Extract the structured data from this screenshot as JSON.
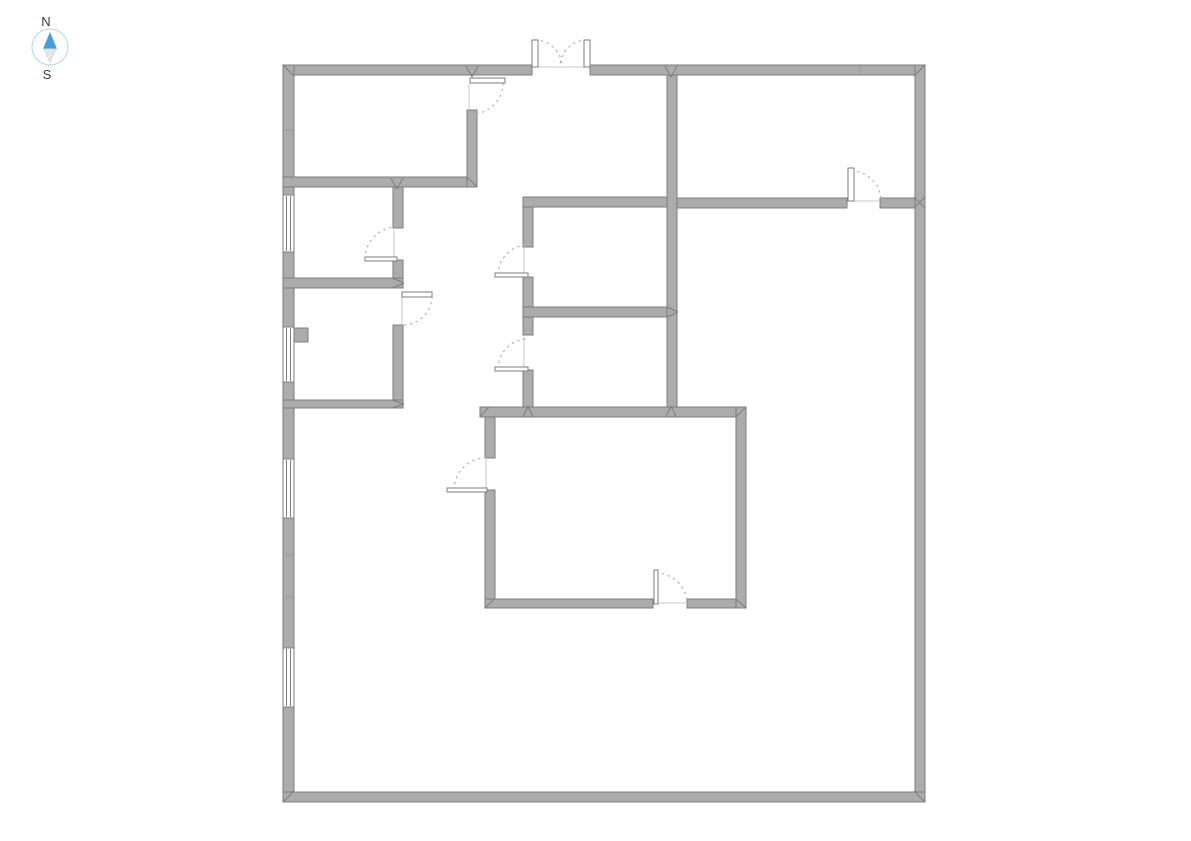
{
  "canvas": {
    "width": 1191,
    "height": 841,
    "background": "#ffffff"
  },
  "compass": {
    "north_label": "N",
    "south_label": "S",
    "cx": 50,
    "cy": 47,
    "r": 18,
    "circle_stroke": "#aed4f2",
    "north_color": "#3f9ede",
    "south_color": "#e4e8ea",
    "south_stroke": "#d2d8da",
    "label_color": "#3a3a3a",
    "north_points": "50,32 43,49 57,49",
    "south_points": "44,49 56,49 50,62"
  },
  "style": {
    "wall_fill": "#acacac",
    "wall_stroke": "#7d7d7d",
    "leaf_fill": "#ffffff",
    "leaf_stroke": "#7d7d7d",
    "arc_color": "#b4b4b4",
    "opening_line_color": "#c9c9c9",
    "seam_color": "#999999",
    "window_fill": "#ffffff",
    "window_stroke": "#7d7d7d"
  },
  "walls": [
    {
      "name": "outer-wall-top-left",
      "x": 283,
      "y": 65,
      "w": 249,
      "h": 10
    },
    {
      "name": "outer-wall-top-right",
      "x": 590,
      "y": 65,
      "w": 335,
      "h": 10
    },
    {
      "name": "outer-wall-left",
      "x": 283,
      "y": 65,
      "w": 11,
      "h": 737
    },
    {
      "name": "outer-wall-right",
      "x": 915,
      "y": 65,
      "w": 10,
      "h": 737
    },
    {
      "name": "outer-wall-bottom",
      "x": 283,
      "y": 792,
      "w": 642,
      "h": 10
    },
    {
      "name": "room1-bottom-wall",
      "x": 283,
      "y": 177,
      "w": 194,
      "h": 10
    },
    {
      "name": "room1-right-wall",
      "x": 467,
      "y": 110,
      "w": 10,
      "h": 77
    },
    {
      "name": "room2-right-wall-upper",
      "x": 393,
      "y": 187,
      "w": 10,
      "h": 41
    },
    {
      "name": "room2-right-wall-lower",
      "x": 393,
      "y": 260,
      "w": 10,
      "h": 28
    },
    {
      "name": "room2-bottom-wall",
      "x": 283,
      "y": 278,
      "w": 120,
      "h": 10
    },
    {
      "name": "room3-right-wall",
      "x": 393,
      "y": 325,
      "w": 10,
      "h": 79
    },
    {
      "name": "room3-bottom-wall",
      "x": 283,
      "y": 400,
      "w": 120,
      "h": 8
    },
    {
      "name": "center-room-top-wall",
      "x": 523,
      "y": 197,
      "w": 144,
      "h": 10
    },
    {
      "name": "center-room-left-stub",
      "x": 523,
      "y": 207,
      "w": 10,
      "h": 40
    },
    {
      "name": "center-room-left-lower",
      "x": 523,
      "y": 277,
      "w": 10,
      "h": 30
    },
    {
      "name": "center-divider-wall",
      "x": 523,
      "y": 307,
      "w": 154,
      "h": 10
    },
    {
      "name": "center-room2-left-upper",
      "x": 523,
      "y": 317,
      "w": 10,
      "h": 18
    },
    {
      "name": "center-room2-left-lower",
      "x": 523,
      "y": 370,
      "w": 10,
      "h": 37
    },
    {
      "name": "main-vertical-wall",
      "x": 667,
      "y": 75,
      "w": 10,
      "h": 332
    },
    {
      "name": "right-room-bottom-left",
      "x": 677,
      "y": 198,
      "w": 170,
      "h": 10
    },
    {
      "name": "right-room-bottom-right",
      "x": 880,
      "y": 198,
      "w": 35,
      "h": 10
    },
    {
      "name": "big-room-top-wall",
      "x": 480,
      "y": 407,
      "w": 266,
      "h": 10
    },
    {
      "name": "big-room-left-upper",
      "x": 485,
      "y": 417,
      "w": 10,
      "h": 41
    },
    {
      "name": "big-room-left-lower",
      "x": 485,
      "y": 490,
      "w": 10,
      "h": 109
    },
    {
      "name": "big-room-bottom-left",
      "x": 485,
      "y": 599,
      "w": 168,
      "h": 9
    },
    {
      "name": "big-room-bottom-right",
      "x": 687,
      "y": 599,
      "w": 58,
      "h": 9
    },
    {
      "name": "big-room-right-wall",
      "x": 736,
      "y": 407,
      "w": 10,
      "h": 201
    },
    {
      "name": "wall-pier",
      "x": 294,
      "y": 328,
      "w": 14,
      "h": 14
    }
  ],
  "windows": [
    {
      "name": "window-left-1",
      "x": 283,
      "y": 195,
      "w": 11,
      "h": 57
    },
    {
      "name": "window-left-2",
      "x": 283,
      "y": 327,
      "w": 11,
      "h": 55
    },
    {
      "name": "window-left-3",
      "x": 283,
      "y": 459,
      "w": 11,
      "h": 59
    },
    {
      "name": "window-left-4",
      "x": 283,
      "y": 648,
      "w": 11,
      "h": 59
    }
  ],
  "doors": [
    {
      "name": "door-room1",
      "leaf": {
        "x": 470,
        "y": 78,
        "w": 35,
        "h": 5
      },
      "arc": "M 503 83 A 31 31 0 0 1 472 114",
      "line": {
        "x1": 469,
        "y1": 84,
        "x2": 469,
        "y2": 110
      }
    },
    {
      "name": "door-room2",
      "leaf": {
        "x": 365,
        "y": 257,
        "w": 32,
        "h": 4
      },
      "arc": "M 365 259 A 32 32 0 0 1 397 227",
      "line": {
        "x1": 394,
        "y1": 230,
        "x2": 394,
        "y2": 257
      }
    },
    {
      "name": "door-room3",
      "leaf": {
        "x": 402,
        "y": 292,
        "w": 30,
        "h": 5
      },
      "arc": "M 432 296 A 29 29 0 0 1 403 325",
      "line": {
        "x1": 402,
        "y1": 297,
        "x2": 402,
        "y2": 324
      }
    },
    {
      "name": "door-center-room1",
      "leaf": {
        "x": 495,
        "y": 273,
        "w": 33,
        "h": 4
      },
      "arc": "M 498 275 A 30 30 0 0 1 528 245",
      "line": {
        "x1": 524,
        "y1": 247,
        "x2": 524,
        "y2": 273
      }
    },
    {
      "name": "door-center-room2",
      "leaf": {
        "x": 495,
        "y": 367,
        "w": 33,
        "h": 4
      },
      "arc": "M 498 369 A 30 30 0 0 1 528 339",
      "line": {
        "x1": 524,
        "y1": 337,
        "x2": 524,
        "y2": 367
      }
    },
    {
      "name": "door-right-room",
      "leaf": {
        "x": 848,
        "y": 168,
        "w": 6,
        "h": 33
      },
      "arc": "M 851 171 A 30 30 0 0 1 881 201",
      "line": {
        "x1": 854,
        "y1": 201,
        "x2": 880,
        "y2": 201
      }
    },
    {
      "name": "door-big-room-left",
      "leaf": {
        "x": 447,
        "y": 488,
        "w": 40,
        "h": 4
      },
      "arc": "M 454 490 A 32 32 0 0 1 486 458",
      "line": {
        "x1": 486,
        "y1": 459,
        "x2": 486,
        "y2": 488
      }
    },
    {
      "name": "door-big-room-bottom",
      "leaf": {
        "x": 654,
        "y": 570,
        "w": 4,
        "h": 34
      },
      "arc": "M 656 573 A 31 31 0 0 1 687 604",
      "line": {
        "x1": 658,
        "y1": 603,
        "x2": 687,
        "y2": 603
      }
    },
    {
      "name": "double-door-left",
      "leaf": {
        "x": 532,
        "y": 40,
        "w": 6,
        "h": 27
      },
      "arc": "M 535 40 A 27 27 0 0 1 562 67",
      "line": {
        "x1": 538,
        "y1": 67,
        "x2": 584,
        "y2": 67
      }
    },
    {
      "name": "double-door-right",
      "leaf": {
        "x": 584,
        "y": 40,
        "w": 6,
        "h": 27
      },
      "arc": "M 587 40 A 27 27 0 0 0 560 67",
      "line": null
    }
  ],
  "seams": [
    {
      "x1": 860,
      "y1": 65,
      "x2": 860,
      "y2": 75
    },
    {
      "x1": 283,
      "y1": 130,
      "x2": 294,
      "y2": 130
    },
    {
      "x1": 283,
      "y1": 555,
      "x2": 294,
      "y2": 555
    },
    {
      "x1": 283,
      "y1": 597,
      "x2": 294,
      "y2": 597
    }
  ],
  "miters": [
    {
      "x1": 283,
      "y1": 65,
      "x2": 294,
      "y2": 76
    },
    {
      "x1": 925,
      "y1": 65,
      "x2": 914,
      "y2": 76
    },
    {
      "x1": 283,
      "y1": 802,
      "x2": 294,
      "y2": 791
    },
    {
      "x1": 925,
      "y1": 802,
      "x2": 914,
      "y2": 791
    },
    {
      "x1": 914,
      "y1": 197,
      "x2": 925,
      "y2": 208
    },
    {
      "x1": 925,
      "y1": 197,
      "x2": 914,
      "y2": 208
    },
    {
      "x1": 467,
      "y1": 177,
      "x2": 477,
      "y2": 187
    },
    {
      "x1": 391,
      "y1": 178,
      "x2": 397,
      "y2": 189
    },
    {
      "x1": 403,
      "y1": 178,
      "x2": 397,
      "y2": 189
    },
    {
      "x1": 466,
      "y1": 66,
      "x2": 472,
      "y2": 77
    },
    {
      "x1": 478,
      "y1": 66,
      "x2": 472,
      "y2": 77
    },
    {
      "x1": 665,
      "y1": 66,
      "x2": 671,
      "y2": 77
    },
    {
      "x1": 677,
      "y1": 66,
      "x2": 671,
      "y2": 77
    },
    {
      "x1": 392,
      "y1": 400,
      "x2": 404,
      "y2": 404
    },
    {
      "x1": 392,
      "y1": 408,
      "x2": 404,
      "y2": 404
    },
    {
      "x1": 392,
      "y1": 278,
      "x2": 404,
      "y2": 283
    },
    {
      "x1": 392,
      "y1": 288,
      "x2": 404,
      "y2": 283
    },
    {
      "x1": 667,
      "y1": 307,
      "x2": 678,
      "y2": 312
    },
    {
      "x1": 667,
      "y1": 317,
      "x2": 678,
      "y2": 312
    },
    {
      "x1": 523,
      "y1": 417,
      "x2": 528,
      "y2": 406
    },
    {
      "x1": 533,
      "y1": 417,
      "x2": 528,
      "y2": 406
    },
    {
      "x1": 666,
      "y1": 417,
      "x2": 671,
      "y2": 406
    },
    {
      "x1": 676,
      "y1": 417,
      "x2": 671,
      "y2": 406
    },
    {
      "x1": 480,
      "y1": 417,
      "x2": 489,
      "y2": 407
    },
    {
      "x1": 746,
      "y1": 407,
      "x2": 736,
      "y2": 417
    },
    {
      "x1": 485,
      "y1": 608,
      "x2": 494,
      "y2": 599
    },
    {
      "x1": 746,
      "y1": 608,
      "x2": 736,
      "y2": 599
    }
  ]
}
